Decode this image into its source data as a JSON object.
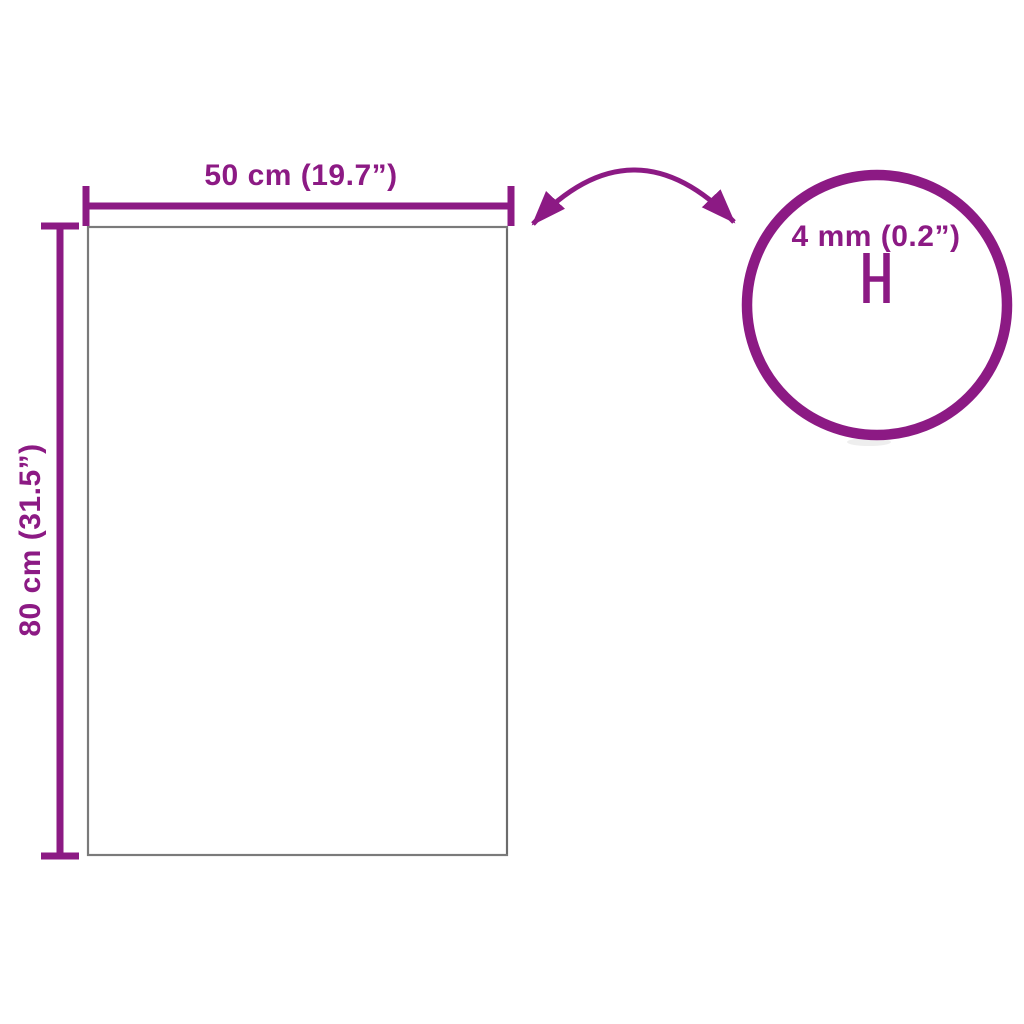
{
  "colors": {
    "accent": "#8C1A84",
    "panel_border": "#7A7A7A",
    "glass_edge": "#C6C6C6",
    "bg": "#FFFFFF"
  },
  "diagram": {
    "title": "Glass panel dimension diagram",
    "width_label": "50 cm (19.7”)",
    "height_label": "80 cm (31.5”)",
    "thickness_label": "4 mm (0.2”)"
  }
}
